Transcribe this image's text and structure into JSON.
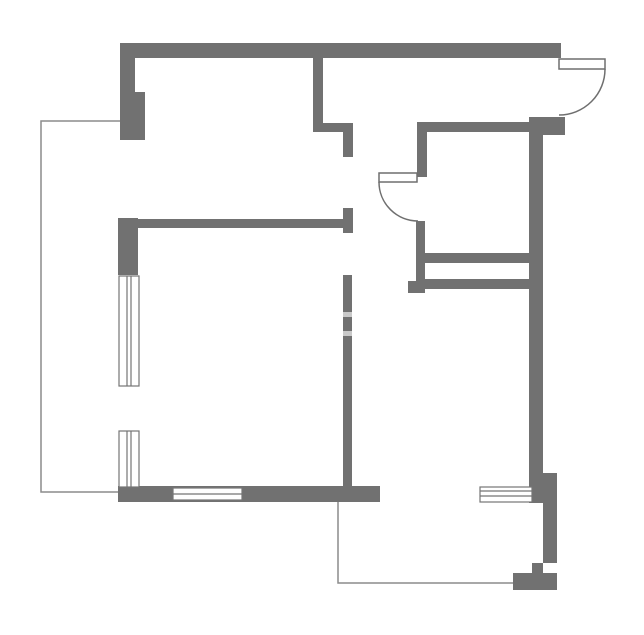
{
  "canvas": {
    "width": 644,
    "height": 635
  },
  "colors": {
    "background": "#ffffff",
    "wall": "#717171",
    "wall_gap": "#c9c9c9",
    "thin_line": "#8c8c8c",
    "window_fill": "#ffffff",
    "window_stroke": "#757575",
    "door_stroke": "#6f6f6f"
  },
  "floorplan": {
    "outlines": [
      {
        "name": "left-balcony-outline",
        "points": "120,121 41,121 41,492 118,492"
      },
      {
        "name": "bottom-balcony-outline",
        "points": "338,502 338,583 513,583"
      }
    ],
    "walls": [
      {
        "name": "top-exterior-wall",
        "x": 120,
        "y": 43,
        "w": 441,
        "h": 15
      },
      {
        "name": "top-left-corner-wall",
        "x": 120,
        "y": 43,
        "w": 15,
        "h": 97
      },
      {
        "name": "top-left-pilaster",
        "x": 135,
        "y": 92,
        "w": 10,
        "h": 48
      },
      {
        "name": "left-wall-block",
        "x": 118,
        "y": 218,
        "w": 20,
        "h": 57
      },
      {
        "name": "bedroom-divider-wall",
        "x": 138,
        "y": 219,
        "w": 210,
        "h": 9
      },
      {
        "name": "divider-end-cap",
        "x": 343,
        "y": 208,
        "w": 10,
        "h": 25
      },
      {
        "name": "hall-partition-vertical",
        "x": 313,
        "y": 58,
        "w": 10,
        "h": 74
      },
      {
        "name": "hall-partition-horizontal",
        "x": 313,
        "y": 123,
        "w": 40,
        "h": 9
      },
      {
        "name": "hall-partition-stub",
        "x": 343,
        "y": 132,
        "w": 10,
        "h": 25
      },
      {
        "name": "central-long-wall",
        "x": 343,
        "y": 275,
        "w": 9,
        "h": 211
      },
      {
        "name": "entry-wall-horizontal",
        "x": 417,
        "y": 122,
        "w": 113,
        "h": 10
      },
      {
        "name": "kitchen-door-wall-upper",
        "x": 417,
        "y": 122,
        "w": 10,
        "h": 55
      },
      {
        "name": "kitchen-door-wall-lower",
        "x": 416,
        "y": 221,
        "w": 9,
        "h": 72
      },
      {
        "name": "kitchen-wall-foot",
        "x": 408,
        "y": 281,
        "w": 17,
        "h": 12
      },
      {
        "name": "closet-bar-upper",
        "x": 425,
        "y": 253,
        "w": 112,
        "h": 10
      },
      {
        "name": "closet-bar-lower",
        "x": 425,
        "y": 279,
        "w": 112,
        "h": 10
      },
      {
        "name": "right-wall-top-block",
        "x": 529,
        "y": 117,
        "w": 36,
        "h": 18
      },
      {
        "name": "right-exterior-wall",
        "x": 529,
        "y": 135,
        "w": 14,
        "h": 368
      },
      {
        "name": "right-wall-side-column",
        "x": 543,
        "y": 473,
        "w": 14,
        "h": 90
      },
      {
        "name": "right-wall-step",
        "x": 532,
        "y": 563,
        "w": 11,
        "h": 10
      },
      {
        "name": "right-wall-bottom-block",
        "x": 513,
        "y": 573,
        "w": 44,
        "h": 17
      },
      {
        "name": "bottom-exterior-wall",
        "x": 118,
        "y": 486,
        "w": 262,
        "h": 16
      }
    ],
    "wall_gaps": [
      {
        "name": "central-wall-joint-upper",
        "x": 343,
        "y": 312,
        "w": 9,
        "h": 5
      },
      {
        "name": "central-wall-joint-lower",
        "x": 343,
        "y": 331,
        "w": 9,
        "h": 5
      }
    ],
    "windows": [
      {
        "name": "left-window-upper",
        "rect": {
          "x": 119,
          "y": 276,
          "w": 20,
          "h": 110
        },
        "lines": [
          {
            "x1": 127,
            "y1": 276,
            "x2": 127,
            "y2": 386
          },
          {
            "x1": 131,
            "y1": 276,
            "x2": 131,
            "y2": 386
          }
        ]
      },
      {
        "name": "left-window-lower",
        "rect": {
          "x": 119,
          "y": 431,
          "w": 20,
          "h": 56
        },
        "lines": [
          {
            "x1": 127,
            "y1": 431,
            "x2": 127,
            "y2": 487
          },
          {
            "x1": 131,
            "y1": 431,
            "x2": 131,
            "y2": 487
          }
        ]
      },
      {
        "name": "bottom-window",
        "rect": {
          "x": 173,
          "y": 488,
          "w": 69,
          "h": 12
        },
        "lines": [
          {
            "x1": 173,
            "y1": 494,
            "x2": 242,
            "y2": 494
          }
        ]
      },
      {
        "name": "bottom-right-window",
        "rect": {
          "x": 480,
          "y": 487,
          "w": 52,
          "h": 15
        },
        "lines": [
          {
            "x1": 480,
            "y1": 491,
            "x2": 532,
            "y2": 491
          },
          {
            "x1": 480,
            "y1": 496,
            "x2": 532,
            "y2": 496
          }
        ]
      }
    ],
    "doors": [
      {
        "name": "entry-door",
        "leaf": {
          "x": 559,
          "y": 59,
          "w": 46,
          "h": 10
        },
        "arc": "M 605 69 A 46 46 0 0 1 559 115"
      },
      {
        "name": "kitchen-door",
        "leaf": {
          "x": 379,
          "y": 173,
          "w": 38,
          "h": 9
        },
        "arc": "M 379 182 A 39 39 0 0 0 418 221"
      }
    ]
  }
}
